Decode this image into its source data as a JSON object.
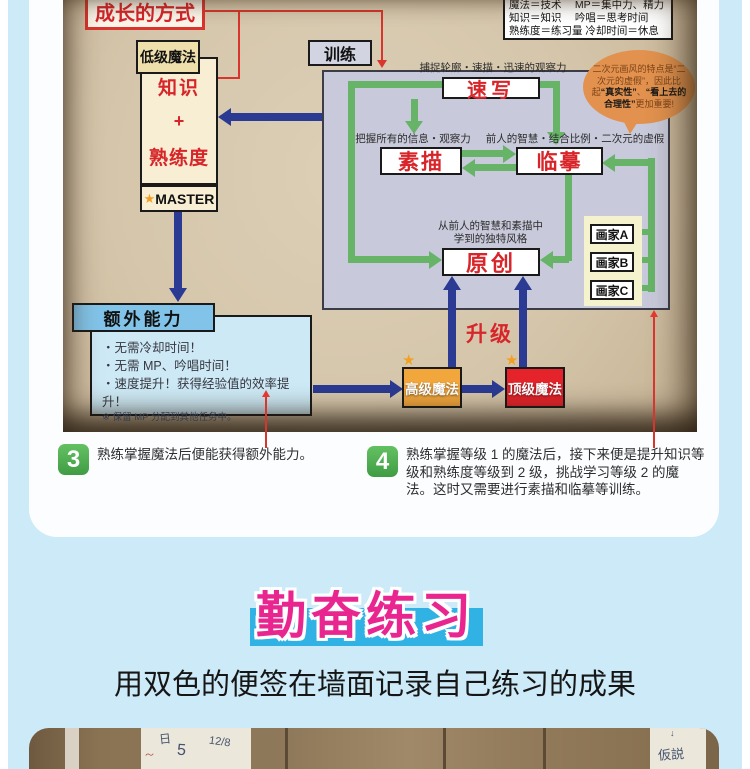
{
  "diagram": {
    "title": "成长的方式",
    "legend": {
      "rows": [
        "魔法＝技术　 MP＝集中力、精力",
        "知识＝知识　 吟唱＝思考时间",
        "熟练度＝练习量 冷却时间＝休息"
      ]
    },
    "low_magic_label": "低级魔法",
    "knowledge_box": {
      "line1": "知识",
      "plus": "+",
      "line2": "熟练度"
    },
    "master": {
      "star": "★",
      "label": "MASTER"
    },
    "training_label": "训练",
    "caption_sketch": "捕捉轮廓・速描・迅速的观察力",
    "sketch": "速写",
    "caption_drawing": "把握所有的信息・观察力",
    "drawing": "素描",
    "caption_copy": "前人的智慧・结合比例・二次元的虚假",
    "copy": "临摹",
    "caption_original_1": "从前人的智慧和素描中",
    "caption_original_2": "学到的独特风格",
    "original": "原创",
    "painters": [
      "画家A",
      "画家B",
      "画家C"
    ],
    "bubble": {
      "p1": "二次元画风的特点是“二次元的虚假”，因此比起",
      "b1": "“真实性”",
      "p2": "、",
      "b2": "“看上去的合理性”",
      "p3": "更加重要!"
    },
    "extra": {
      "header": "额外能力",
      "bullets": [
        "・无需冷却时间！",
        "・无需 MP、吟唱时间！",
        "・速度提升！获得经验值的效率提升！"
      ],
      "note": "※ 保留 MP 分配到其他任务中。"
    },
    "upgrade": "升级",
    "advanced_magic": "高级魔法",
    "top_magic": "顶级魔法",
    "star": "★"
  },
  "notes": [
    {
      "num": "3",
      "text": "熟练掌握魔法后便能获得额外能力。"
    },
    {
      "num": "4",
      "text": "熟练掌握等级 1 的魔法后，接下来便是提升知识等级和熟练度等级到 2 级，挑战学习等级 2 的魔法。这时又需要进行素描和临摹等训练。"
    }
  ],
  "section": {
    "title": "勤奋练习",
    "subtitle": "用双色的便签在墙面记录自己练习的成果"
  },
  "photo_strip": {
    "note1_a": "日",
    "note1_b": "5",
    "note1_c": "12/8",
    "note2": "仮説"
  },
  "colors": {
    "page_blue": "#cdeaf8",
    "parchment": "#d5c6ab",
    "green_arrow": "#67b468",
    "navy_arrow": "#2b3a92",
    "red_accent": "#d8252a",
    "pink_title": "#e9268f",
    "band_blue": "#30b2e5",
    "advanced_orange": "#f2a73d",
    "top_red": "#e5232b"
  }
}
